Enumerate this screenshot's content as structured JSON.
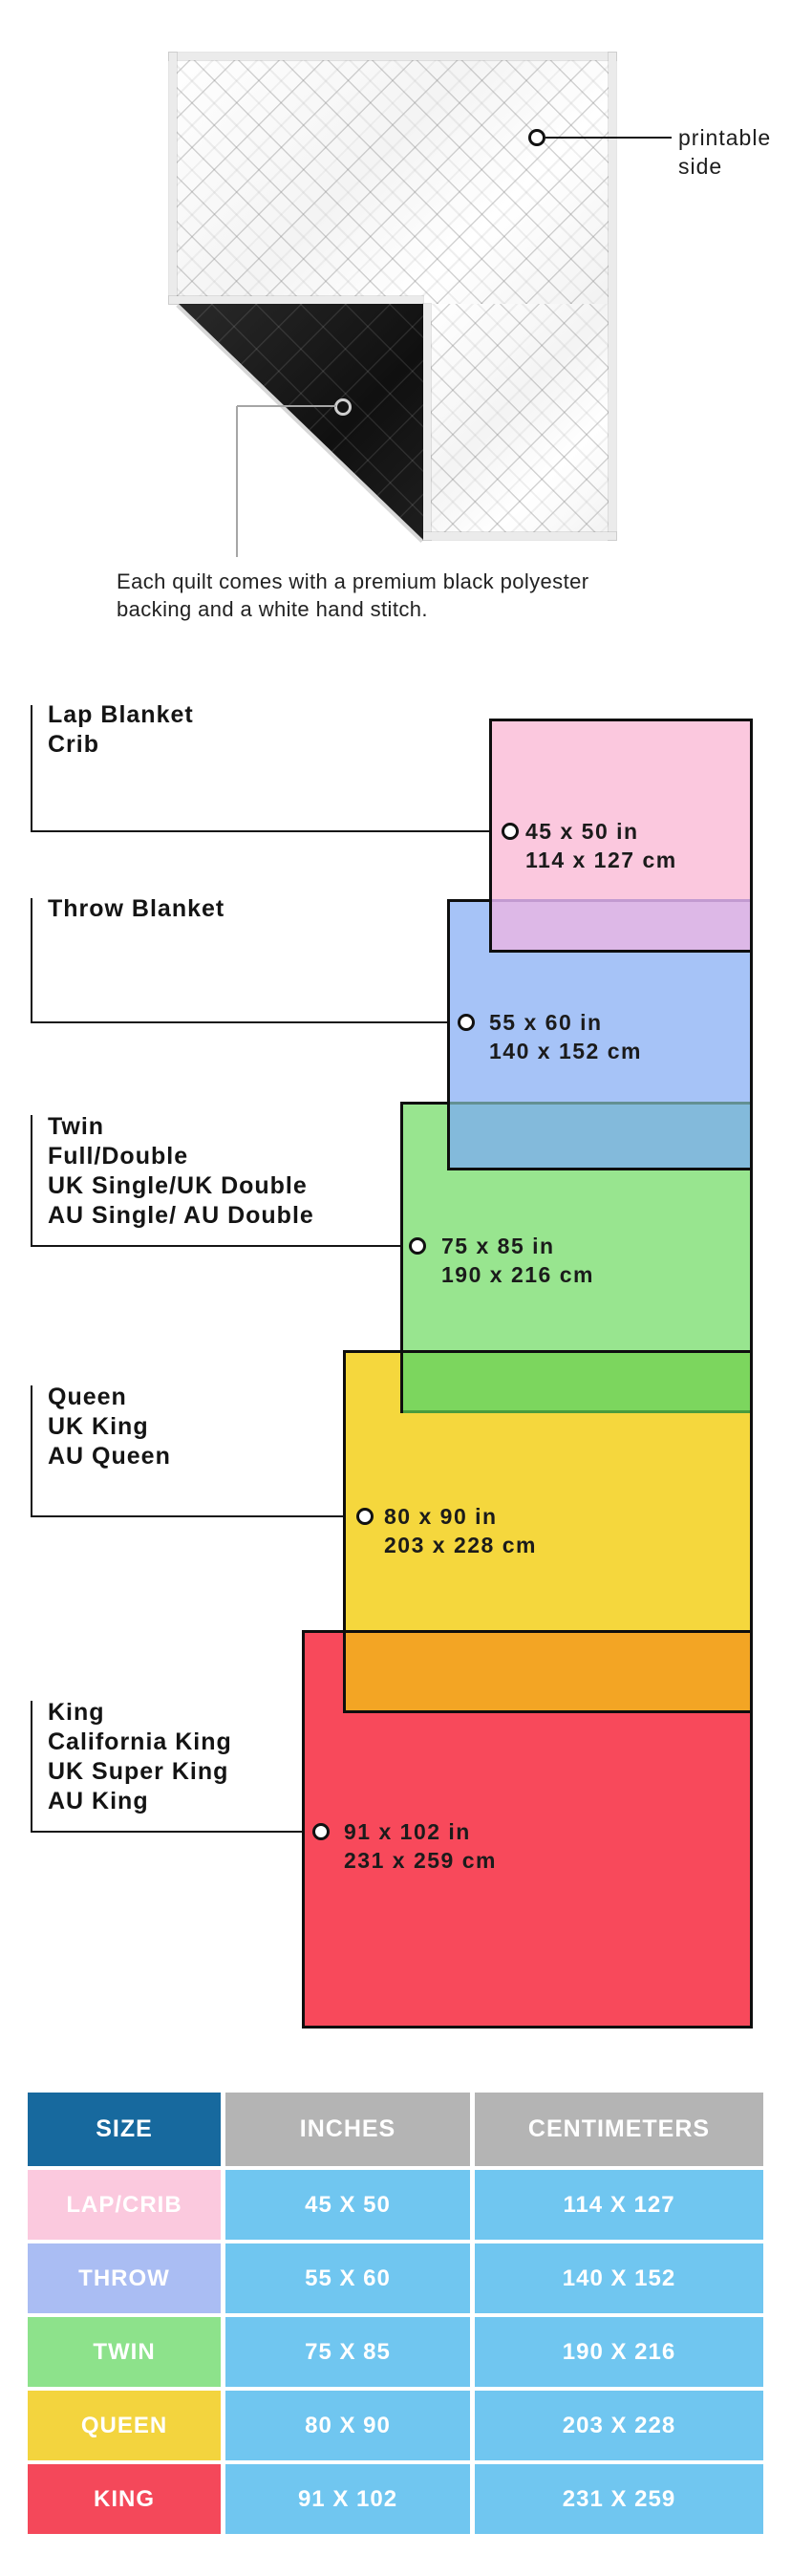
{
  "quilt_section": {
    "printable_label_line1": "printable",
    "printable_label_line2": "side",
    "caption_line1": "Each quilt comes with a premium black polyester",
    "caption_line2": "backing and a white hand stitch.",
    "backing_color": "#151515",
    "binding_color": "#ebebeb"
  },
  "diagram": {
    "sizes": [
      {
        "labels": [
          "Lap Blanket",
          "Crib"
        ],
        "inches": "45 x 50 in",
        "cm": "114 x 127 cm",
        "color": "#fbc8de"
      },
      {
        "labels": [
          "Throw Blanket"
        ],
        "inches": "55 x 60 in",
        "cm": "140 x 152 cm",
        "color": "#a6c3f7"
      },
      {
        "labels": [
          "Twin",
          "Full/Double",
          "UK Single/UK Double",
          "AU Single/ AU Double"
        ],
        "inches": "75 x 85 in",
        "cm": "190 x 216 cm",
        "color": "#98e58f"
      },
      {
        "labels": [
          "Queen",
          "UK King",
          "AU Queen"
        ],
        "inches": "80 x 90 in",
        "cm": "203 x 228 cm",
        "color": "#f5d73d"
      },
      {
        "labels": [
          "King",
          "California King",
          "UK Super King",
          "AU King"
        ],
        "inches": "91 x 102 in",
        "cm": "231 x 259 cm",
        "color": "#f8495b"
      }
    ],
    "overlap_colors": {
      "lap_throw": "#ddb8e7",
      "throw_twin": "#83badb",
      "twin_queen": "#7cd65e",
      "queen_king": "#f3a524"
    }
  },
  "table": {
    "headers": [
      "SIZE",
      "INCHES",
      "CENTIMETERS"
    ],
    "header_size_color": "#17699e",
    "header_measure_color": "#b4b4b4",
    "value_cell_color": "#70c6f0",
    "rows": [
      {
        "size": "LAP/CRIB",
        "inches": "45 X 50",
        "cm": "114 X 127",
        "color": "#fbc9de"
      },
      {
        "size": "THROW",
        "inches": "55 X 60",
        "cm": "140 X 152",
        "color": "#aabdf3"
      },
      {
        "size": "TWIN",
        "inches": "75 X 85",
        "cm": "190 X 216",
        "color": "#8de28b"
      },
      {
        "size": "QUEEN",
        "inches": "80 X 90",
        "cm": "203 X 228",
        "color": "#f3d43e"
      },
      {
        "size": "KING",
        "inches": "91 X 102",
        "cm": "231 X 259",
        "color": "#f4485a"
      }
    ]
  }
}
